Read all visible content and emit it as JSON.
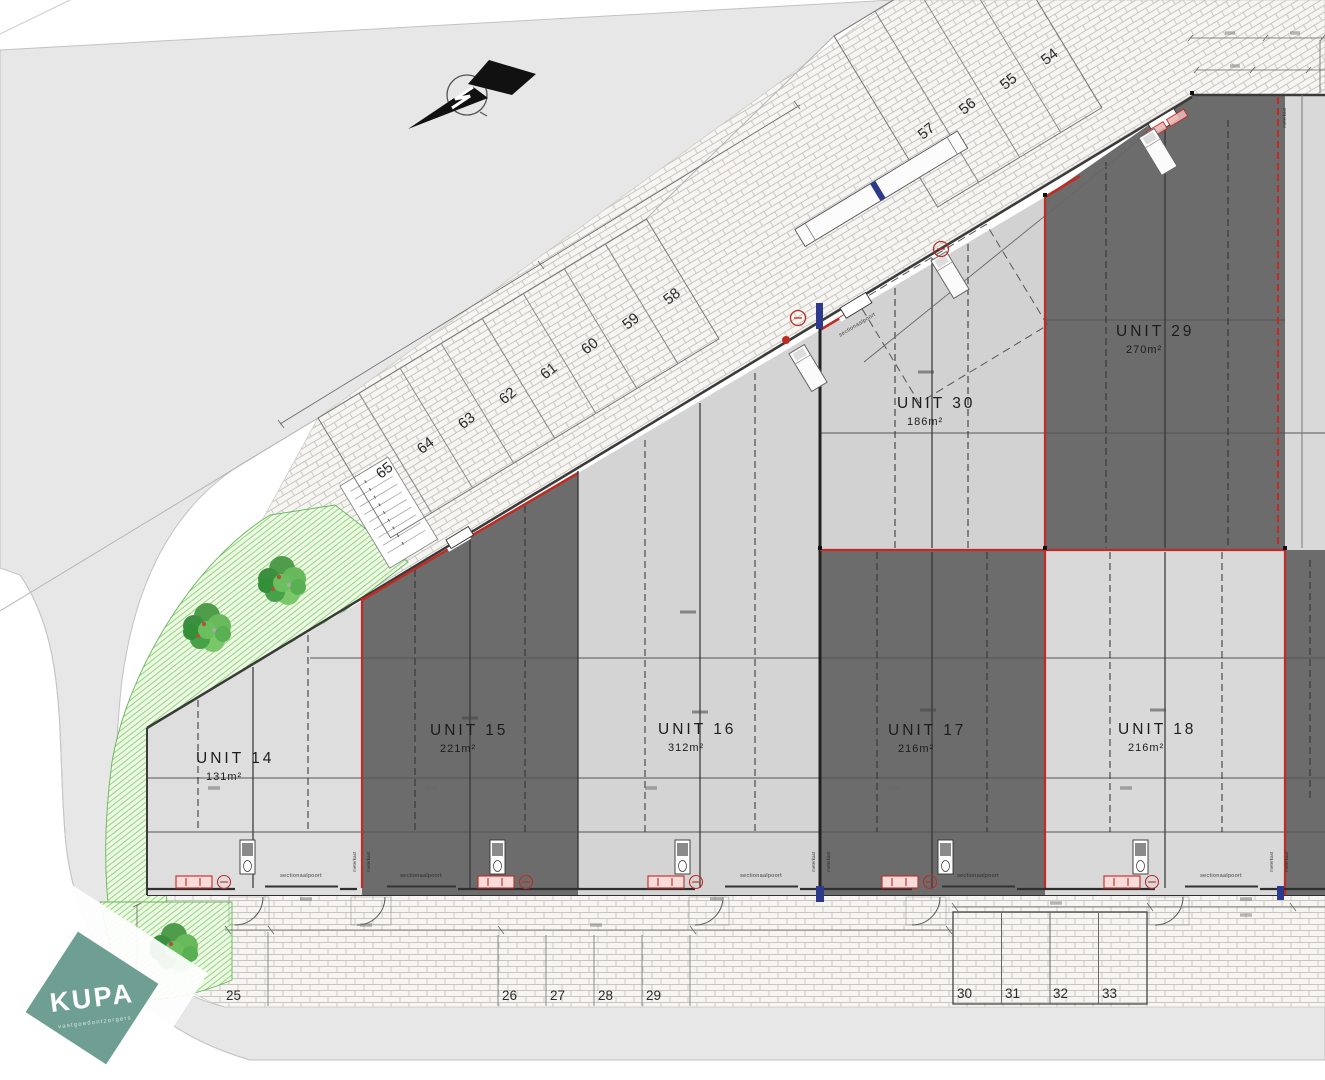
{
  "drawing": {
    "units": [
      {
        "label": "UNIT 14",
        "area": "131m²"
      },
      {
        "label": "UNIT 15",
        "area": "221m²"
      },
      {
        "label": "UNIT 16",
        "area": "312m²"
      },
      {
        "label": "UNIT 17",
        "area": "216m²"
      },
      {
        "label": "UNIT 18",
        "area": "216m²"
      },
      {
        "label": "UNIT 29",
        "area": "270m²"
      },
      {
        "label": "UNIT 30",
        "area": "186m²"
      }
    ],
    "parking_diagonal": [
      "65",
      "64",
      "63",
      "62",
      "61",
      "60",
      "59",
      "58",
      "57",
      "56",
      "55",
      "54"
    ],
    "parking_bottom": [
      "25",
      "26",
      "27",
      "28",
      "29"
    ],
    "parking_bottom_group": [
      "30",
      "31",
      "32",
      "33"
    ],
    "labels": {
      "sectional_door": "sectionaalpoort",
      "meter_closet": "meterkast"
    },
    "logo": {
      "name": "KUPA",
      "tagline": "vastgoedontzorgers"
    },
    "colors": {
      "unit_dark": "#6c6c6c",
      "unit_light": "#d9d9d9",
      "accent_red": "#c02b24",
      "logo_teal": "#6f9f92",
      "green_fill": "#eef8e4",
      "road_gray": "#e7e7e7"
    }
  }
}
